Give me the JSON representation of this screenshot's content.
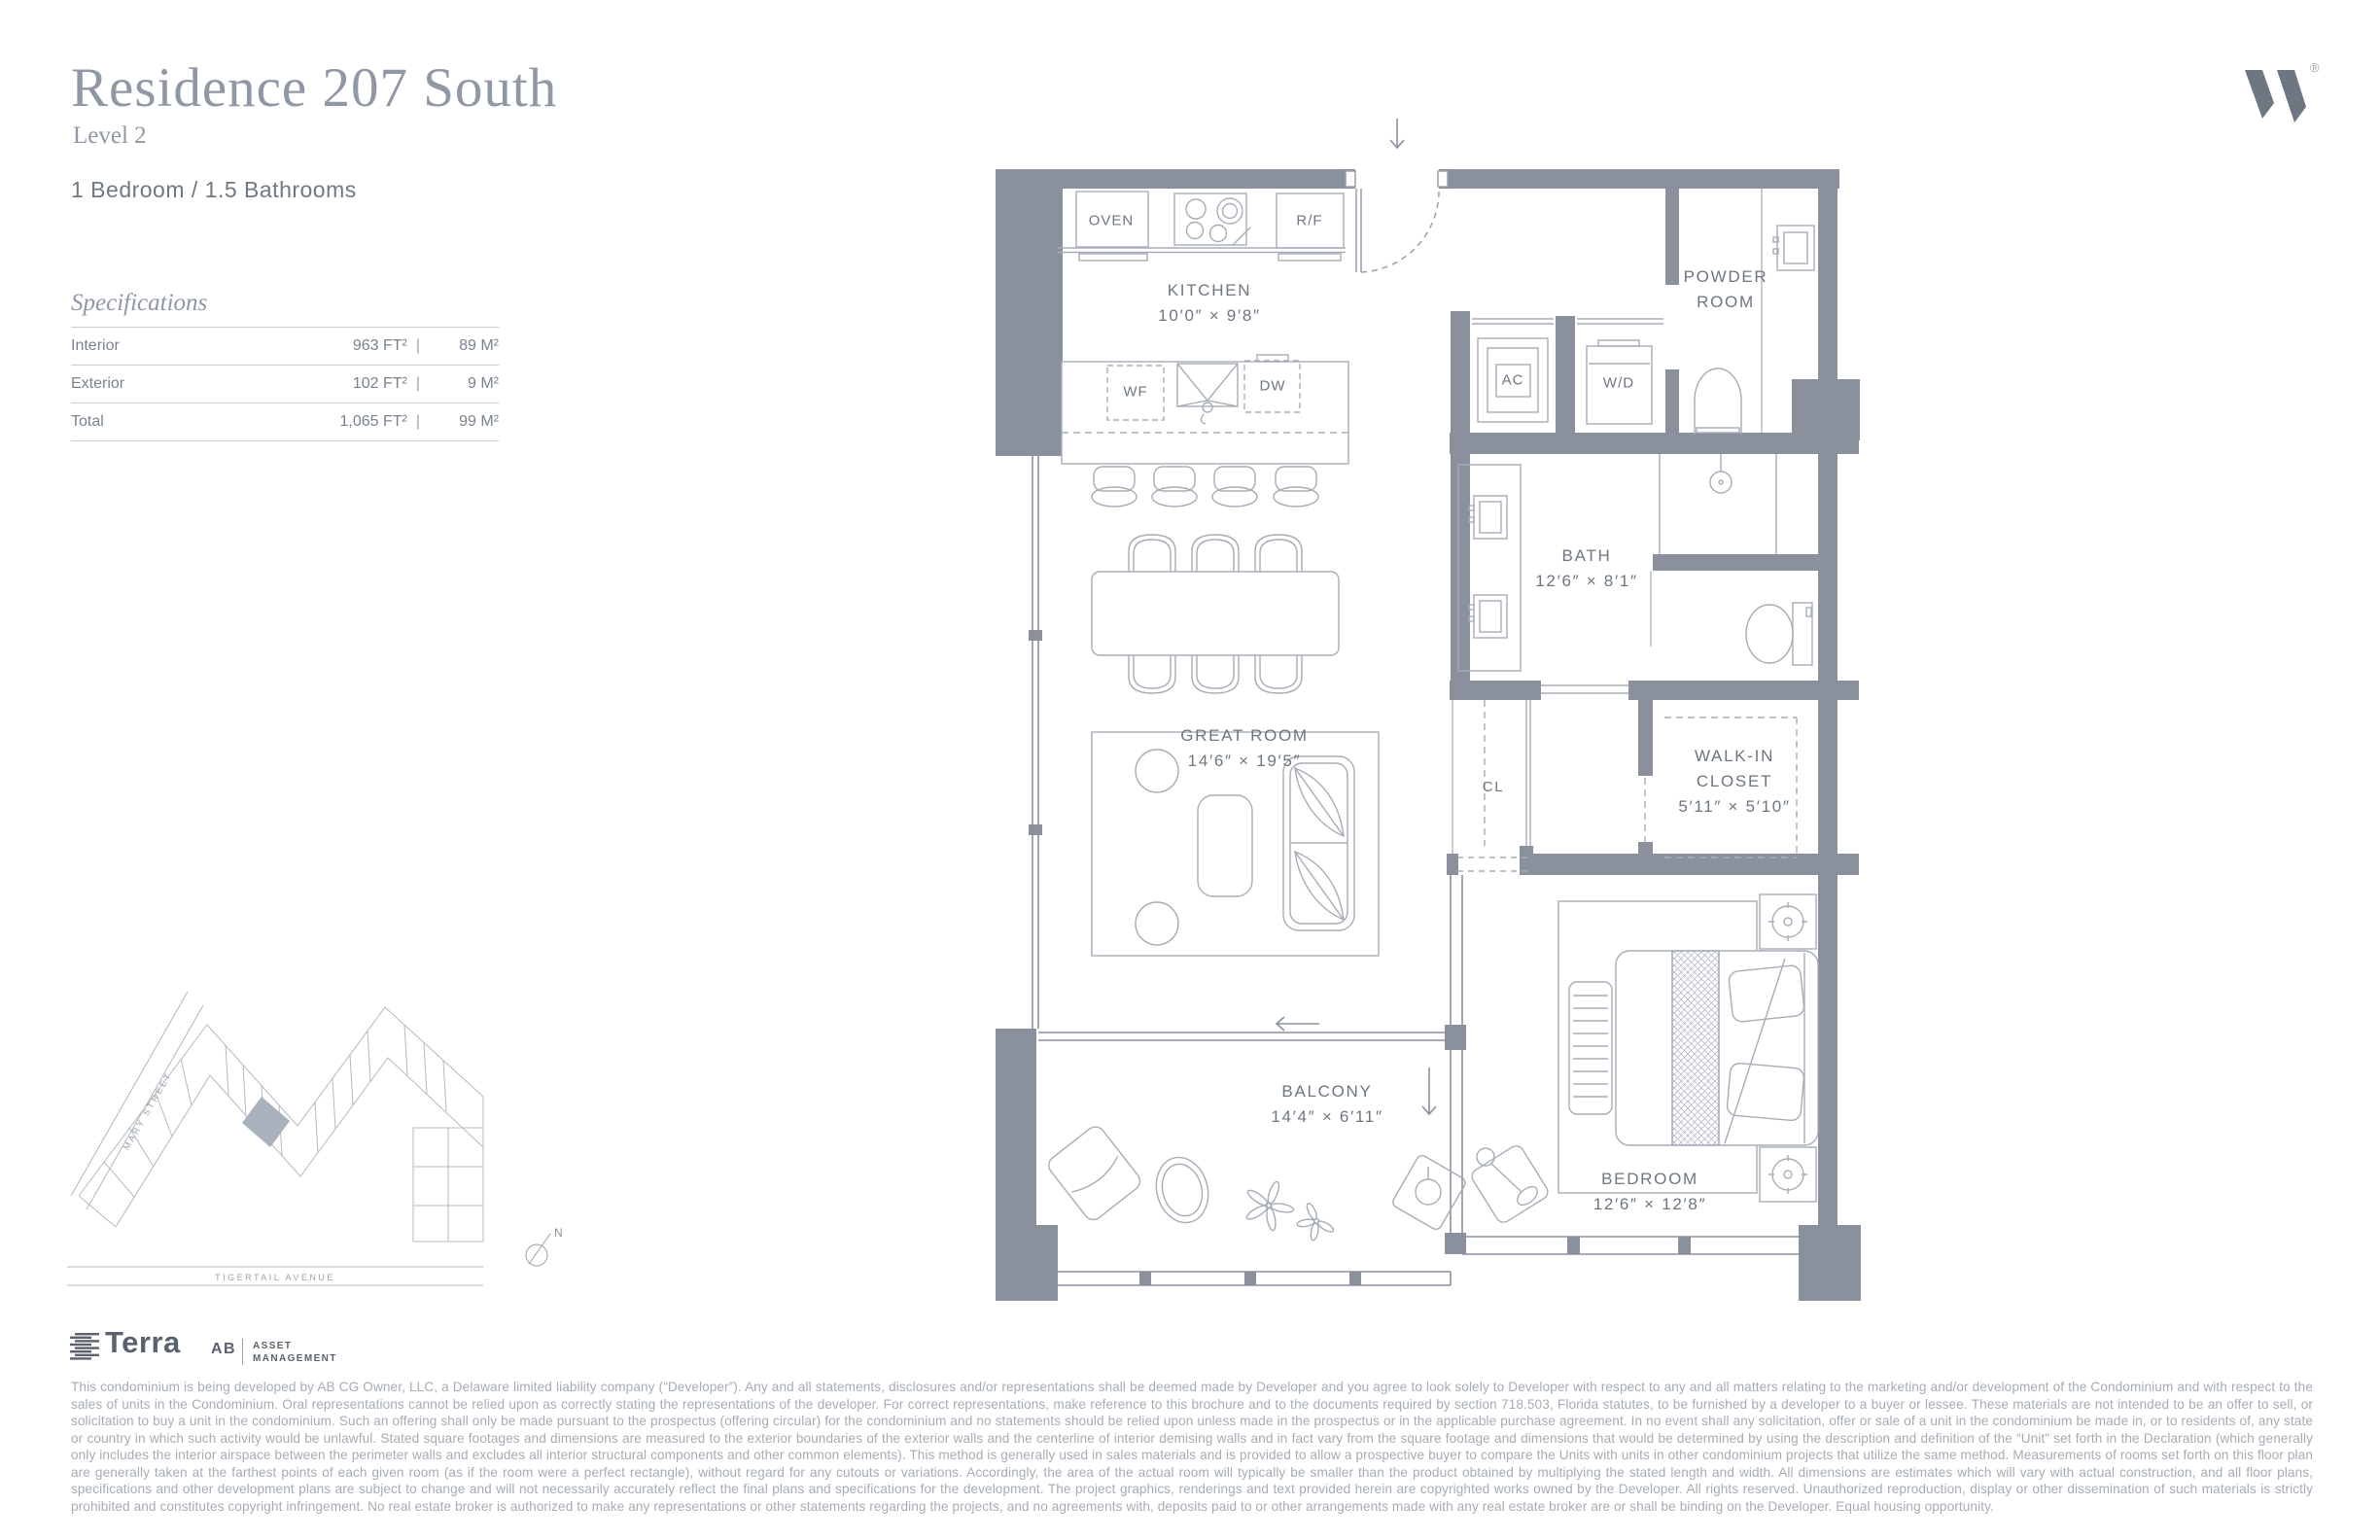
{
  "header": {
    "title": "Residence 207 South",
    "level": "Level 2",
    "configuration": "1 Bedroom / 1.5 Bathrooms"
  },
  "specifications": {
    "heading": "Specifications",
    "divider": "|",
    "rows": [
      {
        "label": "Interior",
        "imperial": "963 FT²",
        "metric": "89 M²"
      },
      {
        "label": "Exterior",
        "imperial": "102 FT²",
        "metric": "9 M²"
      },
      {
        "label": "Total",
        "imperial": "1,065 FT²",
        "metric": "99 M²"
      }
    ]
  },
  "brand": {
    "registered": "®"
  },
  "floor_plan": {
    "rooms": {
      "kitchen": {
        "name": "KITCHEN",
        "dims": "10′0″ × 9′8″"
      },
      "great_room": {
        "name": "GREAT ROOM",
        "dims": "14′6″ × 19′5″"
      },
      "balcony": {
        "name": "BALCONY",
        "dims": "14′4″ × 6′11″"
      },
      "bedroom": {
        "name": "BEDROOM",
        "dims": "12′6″ × 12′8″"
      },
      "bath": {
        "name": "BATH",
        "dims": "12′6″ × 8′1″"
      },
      "powder_room": {
        "line1": "POWDER",
        "line2": "ROOM"
      },
      "walk_in_closet": {
        "line1": "WALK-IN",
        "line2": "CLOSET",
        "dims": "5′11″ × 5′10″"
      },
      "closet": {
        "name": "CL"
      }
    },
    "appliances": {
      "oven": "OVEN",
      "fridge": "R/F",
      "wine_fridge": "WF",
      "dishwasher": "DW",
      "air_conditioner": "AC",
      "washer_dryer": "W/D"
    }
  },
  "site_plan": {
    "street_left": "MARY STREET",
    "street_bottom": "TIGERTAIL AVENUE",
    "compass": "N"
  },
  "footer": {
    "developer": "Terra",
    "partner": "AB",
    "partner_division_line1": "ASSET",
    "partner_division_line2": "MANAGEMENT",
    "disclaimer": "This condominium is being developed by AB CG Owner, LLC, a Delaware limited liability company (“Developer”). Any and all statements, disclosures and/or representations shall be deemed made by Developer and you agree to look solely to Developer with respect to any and all matters relating to the marketing and/or development of the Condominium and with respect to the sales of units in the Condominium. Oral representations cannot be relied upon as correctly stating the representations of the developer. For correct representations, make reference to this brochure and to the documents required by section 718.503, Florida statutes, to be furnished by a developer to a buyer or lessee. These materials are not intended to be an offer to sell, or solicitation to buy a unit in the condominium. Such an offering shall only be made pursuant to the prospectus (offering circular) for the condominium and no statements should be relied upon unless made in the prospectus or in the applicable purchase agreement. In no event shall any solicitation, offer or sale of a unit in the condominium be made in, or to residents of, any state or country in which such activity would be unlawful. Stated square footages and dimensions are measured to the exterior boundaries of the exterior walls and the centerline of interior demising walls and in fact vary from the square footage and dimensions that would be determined by using the description and definition of the “Unit” set forth in the Declaration (which generally only includes the interior airspace between the perimeter walls and excludes all interior structural components and other common elements). This method is generally used in sales materials and is provided to allow a prospective buyer to compare the Units with units in other condominium projects that utilize the same method. Measurements of rooms set forth on this floor plan are generally taken at the farthest points of each given room (as if the room were a perfect rectangle), without regard for any cutouts or variations. Accordingly, the area of the actual room will typically be smaller than the product obtained by multiplying the stated length and width. All dimensions are estimates which will vary with actual construction, and all floor plans, specifications and other development plans are subject to change and will not necessarily accurately reflect the final plans and specifications for the development. The project graphics, renderings and text provided herein are copyrighted works owned by the Developer. All rights reserved. Unauthorized reproduction, display or other dissemination of such materials is strictly prohibited and constitutes copyright infringement. No real estate broker is authorized to make any representations or other statements regarding the projects, and no agreements with, deposits paid to or other arrangements made with any real estate broker are or shall be binding on the Developer. Equal housing opportunity."
  }
}
